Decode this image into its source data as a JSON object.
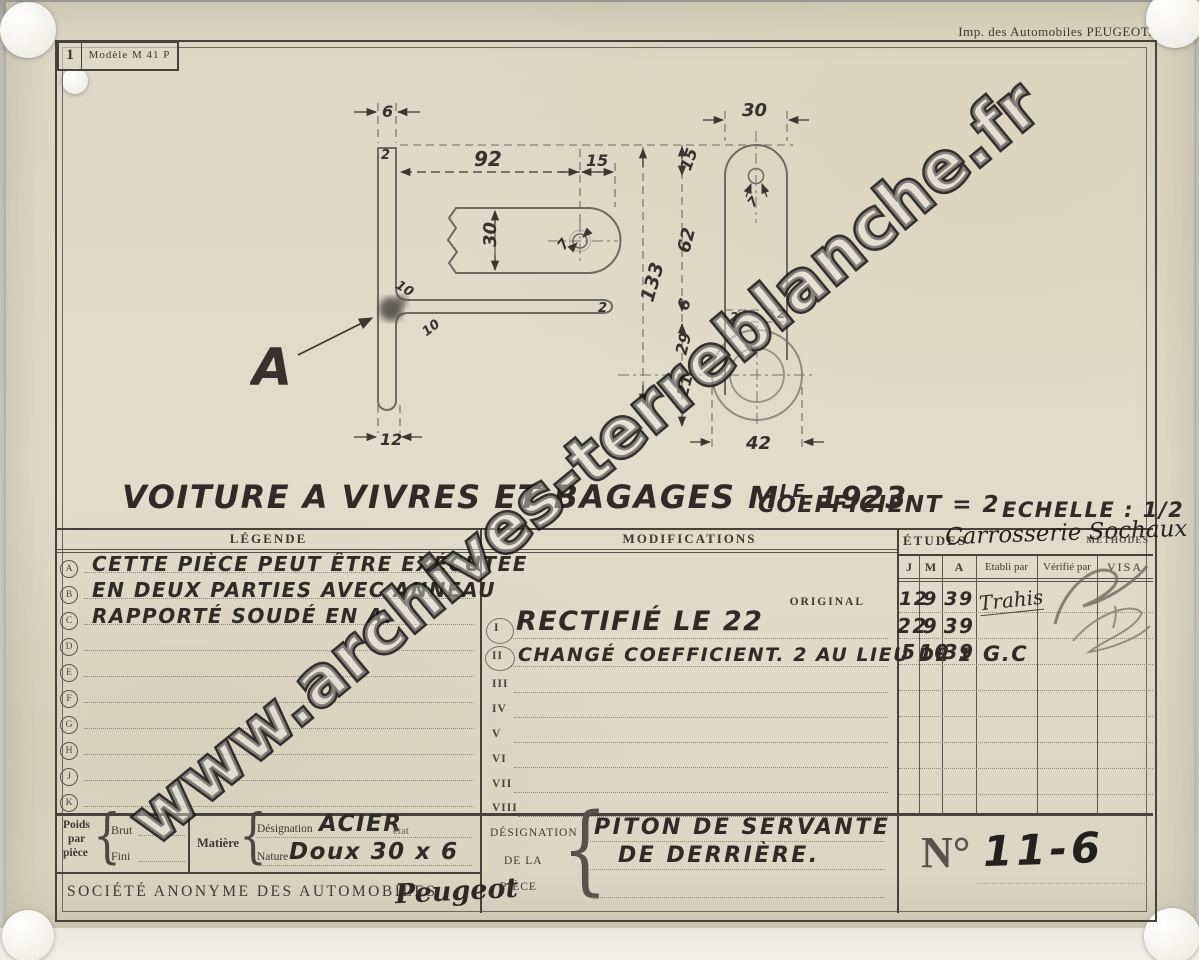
{
  "page": {
    "imprint": "Imp. des Automobiles PEUGEOT."
  },
  "model_box": {
    "number": "1",
    "label": "Modèle M 41 P"
  },
  "watermark": "www.archives-terreblanche.fr",
  "title": {
    "main": "VOITURE A VIVRES ET BAGAGES",
    "model_abbr": "M",
    "model_sup": "LE",
    "year": "1923",
    "coefficient": "COEFFICIENT = 2",
    "echelle": "ECHELLE : 1/2"
  },
  "drawing": {
    "a_marker": "A",
    "dims": {
      "s6": "6",
      "s2a": "2",
      "s92": "92",
      "s15": "15",
      "s30": "30",
      "s7": "7",
      "s133": "133",
      "s10a": "10",
      "s10b": "10",
      "s2b": "2",
      "s12": "12",
      "f30": "30",
      "f15": "15",
      "f7": "7",
      "f62": "62",
      "f6": "6",
      "f29": "29",
      "f21": "21",
      "f2a": "2",
      "f2b": "2",
      "f42": "42"
    }
  },
  "legend": {
    "header": "LÉGENDE",
    "rows": [
      {
        "letter": "A",
        "text": "CETTE PIÈCE PEUT ÊTRE EXÉCUTÉE"
      },
      {
        "letter": "B",
        "text": "EN DEUX PARTIES AVEC ANNEAU"
      },
      {
        "letter": "C",
        "text": "RAPPORTÉ SOUDÉ EN A."
      },
      {
        "letter": "D",
        "text": ""
      },
      {
        "letter": "E",
        "text": ""
      },
      {
        "letter": "F",
        "text": ""
      },
      {
        "letter": "G",
        "text": ""
      },
      {
        "letter": "H",
        "text": ""
      },
      {
        "letter": "J",
        "text": ""
      },
      {
        "letter": "K",
        "text": ""
      }
    ]
  },
  "modifications": {
    "header": "MODIFICATIONS",
    "original": "ORIGINAL",
    "rows": [
      {
        "num": "I",
        "text": "RECTIFIÉ LE 22"
      },
      {
        "num": "II",
        "text": "CHANGÉ COEFFICIENT. 2 AU LIEU DE 1"
      },
      {
        "num": "III",
        "text": ""
      },
      {
        "num": "IV",
        "text": ""
      },
      {
        "num": "V",
        "text": ""
      },
      {
        "num": "VI",
        "text": ""
      },
      {
        "num": "VII",
        "text": ""
      },
      {
        "num": "VIII",
        "text": ""
      }
    ]
  },
  "etudes": {
    "header": "ÉTUDES",
    "methodes": "MÉTHODES",
    "service": "Carrosserie Sochaux",
    "columns": {
      "j": "J",
      "m": "M",
      "a": "A",
      "etabli": "Etabli par",
      "verifie": "Vérifié par",
      "visa": "VISA"
    },
    "rows": [
      {
        "j": "12",
        "m": "9",
        "a": "39",
        "etabli": "Trahis",
        "verifie": "",
        "visa": ""
      },
      {
        "j": "22",
        "m": "9",
        "a": "39",
        "etabli": "",
        "verifie": "",
        "visa": ""
      },
      {
        "j": "5",
        "m": "10",
        "a": "39",
        "etabli": "G.C",
        "verifie": "",
        "visa": ""
      }
    ]
  },
  "bottom": {
    "poids_l1": "Poids",
    "poids_l2": "par",
    "poids_l3": "pièce",
    "brut": "Brut",
    "fini": "Fini",
    "matiere": "Matière",
    "designation": "Désignation",
    "designation_value": "ACIER",
    "etat": "état",
    "nature": "Nature",
    "nature_value": "Doux 30 x 6",
    "societe": "SOCIÉTÉ ANONYME DES AUTOMOBILES",
    "societe_script": "Peugeot"
  },
  "piece": {
    "l1": "DÉSIGNATION",
    "l2": "DE LA",
    "l3": "PIÈCE",
    "value_line1": "PITON DE SERVANTE",
    "value_line2": "DE DERRIÈRE.",
    "numero_label": "N°",
    "numero_value": "11-6"
  }
}
